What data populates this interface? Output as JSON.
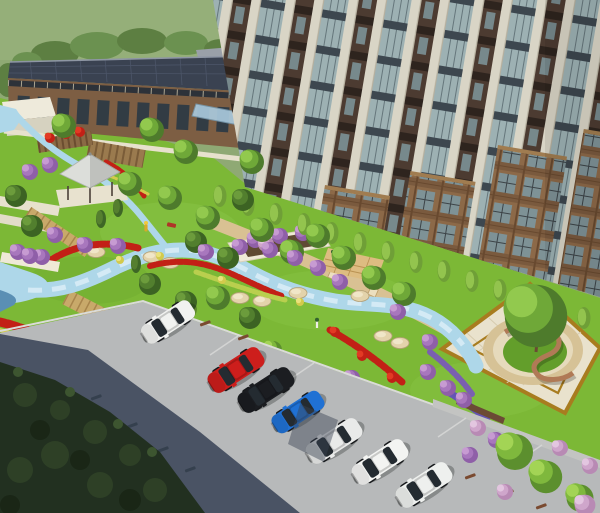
{
  "meta": {
    "title": "Aerial 3D architectural rendering of a residential courtyard landscape with garden, stream, plaza and parking",
    "width": 600,
    "height": 513
  },
  "palette": {
    "hill": "#8fa974",
    "hillLight": "#9db580",
    "treeline": "#5d7f42",
    "lawn": "#7cb836",
    "lawnLight": "#90c94c",
    "lawnDark": "#639e2b",
    "roofSlate": "#3a4251",
    "roofLine": "#545e73",
    "brickOffice": "#7d5e43",
    "winDark": "#323c44",
    "cream": "#d9d5c6",
    "glass": "#9db1b3",
    "towerPanel": "#4c3b31",
    "towerBrick": "#8c6948",
    "canopy": "#a9c9dc",
    "stream": "#aed7e9",
    "streamLight": "#ddeff7",
    "streamDeep": "#5a8fb4",
    "pathCream": "#e7e1cd",
    "pathTan": "#d9c193",
    "boardwalk": "#c8a96a",
    "boardwalkDark": "#a8854c",
    "gold": "#a87c1f",
    "plazaPave": "#e9e2cd",
    "plazaStone": "#d6c296",
    "wallBrick": "#b07a56",
    "flowerRed": "#c22016",
    "flowerYellow": "#d3ca4c",
    "flowerPurple": "#8f5fa8",
    "flowerPink": "#cfa6cb",
    "flowerViolet": "#6454b4",
    "road": "#b7b9ba",
    "roadShadow": "#4a5364",
    "foliageDark": "#223020",
    "curb": "#dadbd8",
    "wheelStop": "#7a4a30",
    "whiteBldg": "#eeeadb"
  },
  "scene": {
    "setting": "bird's-eye view rendering of landscaped residential grounds",
    "buildings": [
      {
        "name": "office-low-rise",
        "desc": "brick low-rise with dark slate flat roof, clerestory band and glass entrance canopy"
      },
      {
        "name": "residential-tower",
        "desc": "tilted high-rise with cream pilasters, blue-grey glazing, dark spandrel panels and staggered brick frames"
      }
    ],
    "landscape": [
      "winding light-blue stream with boulders",
      "red, yellow, purple and pink flower beds",
      "garden pavilion with grey pyramid roof",
      "wooden pergola and tilled planting beds",
      "striped timber boardwalks",
      "white raised planter with purple shrubs",
      "square plaza with gold border, circular stone ring, curved brick wall and central tree",
      "hedge row along tower base"
    ],
    "road": {
      "desc": "diagonal parking road with angled stalls and wheel stops",
      "shadow": "deep tree shadow across lower-left of the road"
    }
  },
  "objects": {
    "cars": [
      {
        "name": "white-suv",
        "hex": "#f1f2f0"
      },
      {
        "name": "red-sedan",
        "hex": "#cd1e1c"
      },
      {
        "name": "black-sedan",
        "hex": "#1b1d21"
      },
      {
        "name": "blue-hatchback",
        "hex": "#2071d4"
      },
      {
        "name": "silver-sedan",
        "hex": "#e9eae9"
      },
      {
        "name": "white-sedan",
        "hex": "#f3f4f2"
      },
      {
        "name": "white-sedan-2",
        "hex": "#eef0ee"
      }
    ]
  }
}
